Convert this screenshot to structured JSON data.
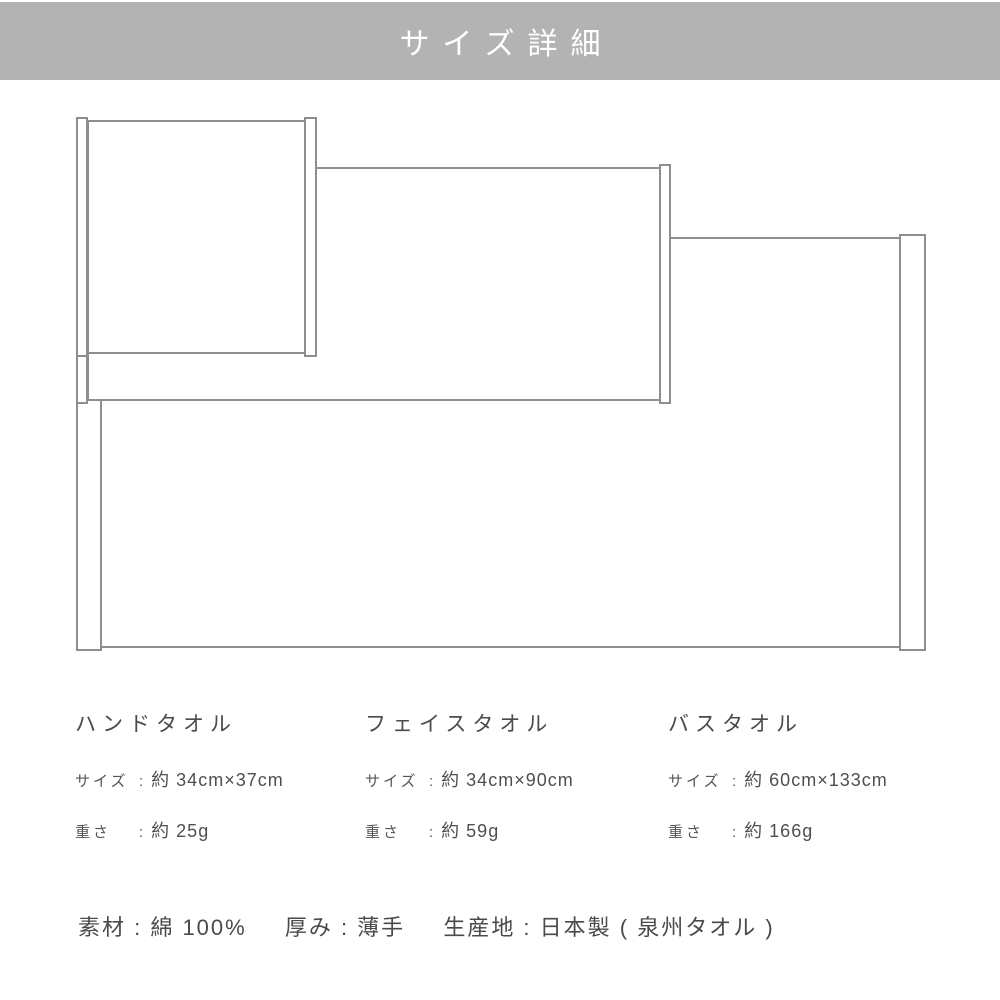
{
  "header": {
    "title": "サイズ詳細"
  },
  "diagram": {
    "towels": [
      {
        "id": "hand-towel",
        "label": "ハンドタオル"
      },
      {
        "id": "face-towel",
        "label": "フェイスタオル"
      },
      {
        "id": "bath-towel",
        "label": "バスタオル"
      }
    ]
  },
  "colon": ":",
  "columns": [
    {
      "name": "ハンドタオル",
      "size_label": "サイズ",
      "size_value": "約 34cm×37cm",
      "weight_label": "重さ",
      "weight_value": "約 25g"
    },
    {
      "name": "フェイスタオル",
      "size_label": "サイズ",
      "size_value": "約 34cm×90cm",
      "weight_label": "重さ",
      "weight_value": "約 59g"
    },
    {
      "name": "バスタオル",
      "size_label": "サイズ",
      "size_value": "約 60cm×133cm",
      "weight_label": "重さ",
      "weight_value": "約 166g"
    }
  ],
  "footer": {
    "segments": [
      "素材 : 綿 100%",
      "厚み : 薄手",
      "生産地 : 日本製 ( 泉州タオル )"
    ]
  },
  "colors": {
    "banner_gray": "#b3b3b3",
    "outline_gray": "#8e8e8e",
    "text_gray": "#4f4f4f"
  }
}
